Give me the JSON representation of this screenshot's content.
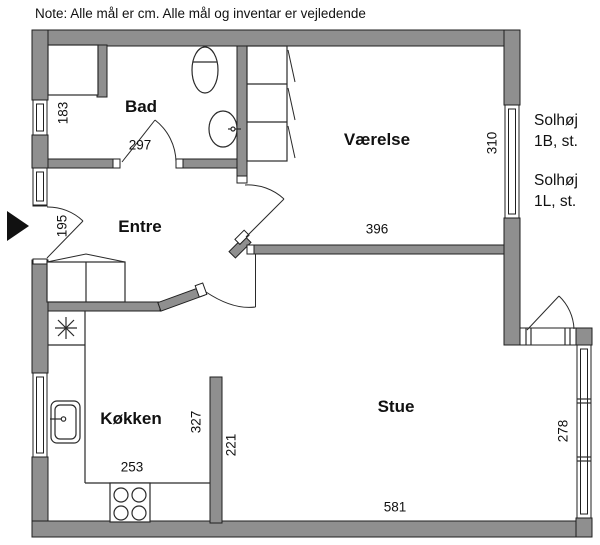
{
  "note": "Note: Alle mål er cm. Alle mål og inventar er vejledende",
  "colors": {
    "wall_fill": "#8f8f8f",
    "outline": "#1f1f1f",
    "background": "#ffffff"
  },
  "rooms": {
    "bad": {
      "label": "Bad"
    },
    "entre": {
      "label": "Entre"
    },
    "vaerelse": {
      "label": "Værelse"
    },
    "koekken": {
      "label": "Køkken"
    },
    "stue": {
      "label": "Stue"
    }
  },
  "measurements": {
    "bad_niche_depth": "183",
    "bad_width": "297",
    "entrance_opening": "195",
    "vaerelse_depth": "310",
    "vaerelse_width": "396",
    "koekken_depth": "327",
    "divider_wall": "221",
    "koekken_width": "253",
    "stue_width": "581",
    "stue_window_section": "278"
  },
  "address_labels": {
    "unit1_line1": "Solhøj",
    "unit1_line2": "1B, st.",
    "unit2_line1": "Solhøj",
    "unit2_line2": "1L, st."
  },
  "fixtures": [
    "toilet",
    "washbasin",
    "shower-niche",
    "wardrobe-vaerelse",
    "wardrobe-entre",
    "fridge-star",
    "kitchen-sink",
    "stove-4-burners",
    "entrance-arrow"
  ]
}
